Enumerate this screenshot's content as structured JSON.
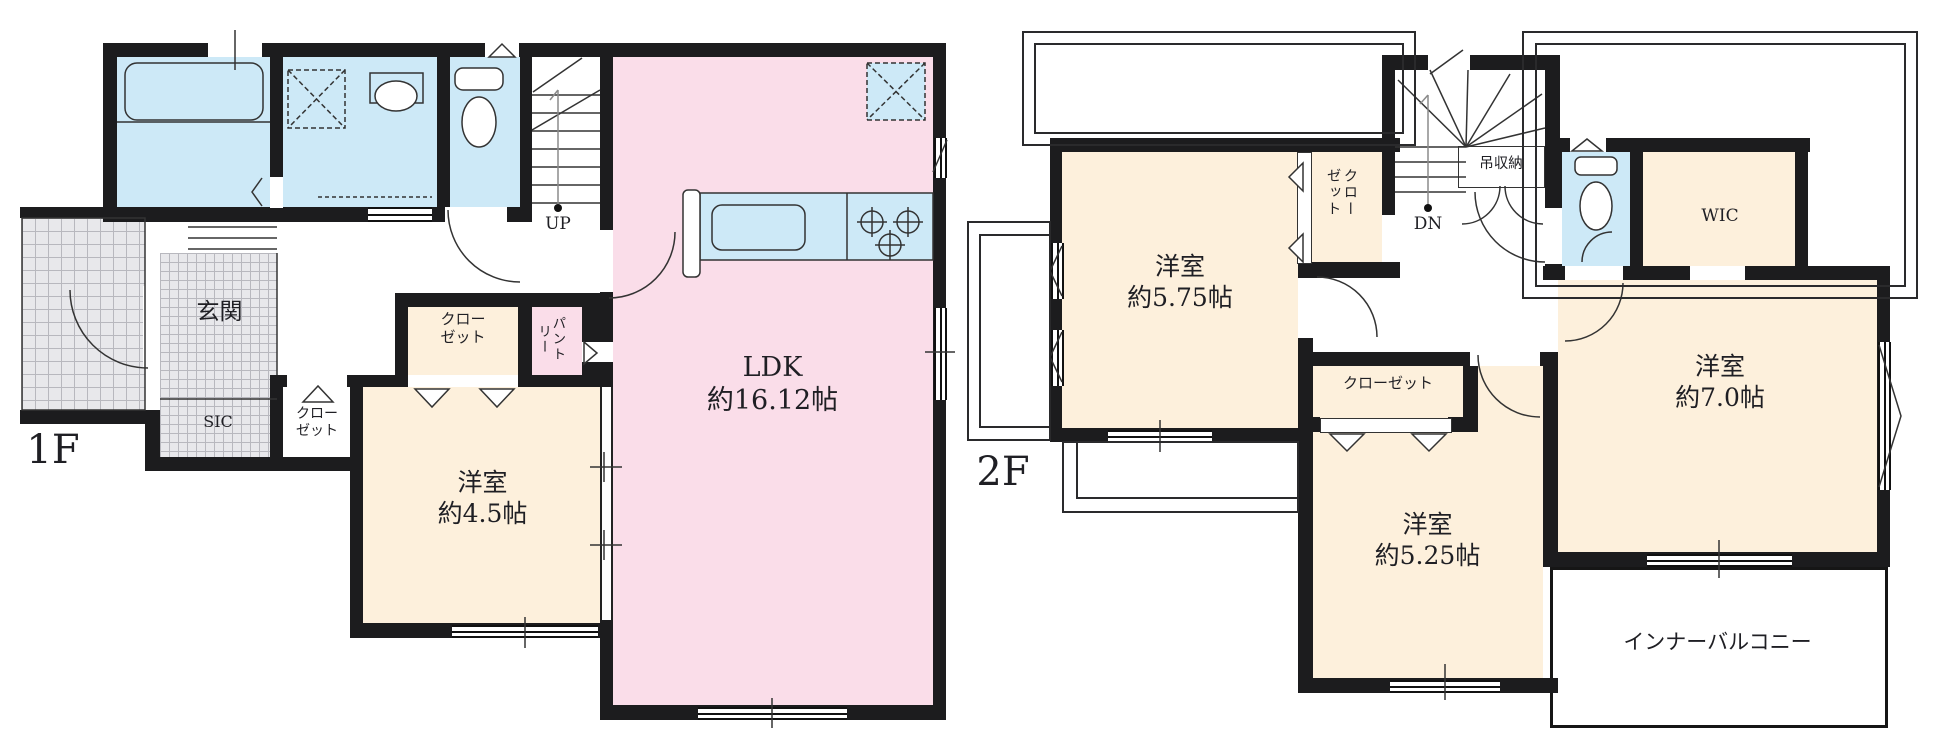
{
  "palette": {
    "wall": "#1c1c1e",
    "blue": "#cde9f7",
    "pink": "#fadde9",
    "cream": "#fdf0dc",
    "tile": "#e8e8eb",
    "tile_line": "#b8b8be"
  },
  "floor1": {
    "floor_label": "1F",
    "genkan": "玄関",
    "sic": "SIC",
    "hall_closet": [
      "クロー",
      "ゼット"
    ],
    "room_closet": [
      "クロー",
      "ゼット"
    ],
    "pantry": "パントリー",
    "stairs_up": "UP",
    "ldk": [
      "LDK",
      "約16.12帖"
    ],
    "room45": [
      "洋室",
      "約4.5帖"
    ]
  },
  "floor2": {
    "floor_label": "2F",
    "stairs_dn": "DN",
    "hanging_storage": "吊収納",
    "closet_575": "クローゼット",
    "closet_525": "クローゼット",
    "wic": "WIC",
    "room575": [
      "洋室",
      "約5.75帖"
    ],
    "room70": [
      "洋室",
      "約7.0帖"
    ],
    "room525": [
      "洋室",
      "約5.25帖"
    ],
    "inner_balcony": "インナーバルコニー"
  }
}
